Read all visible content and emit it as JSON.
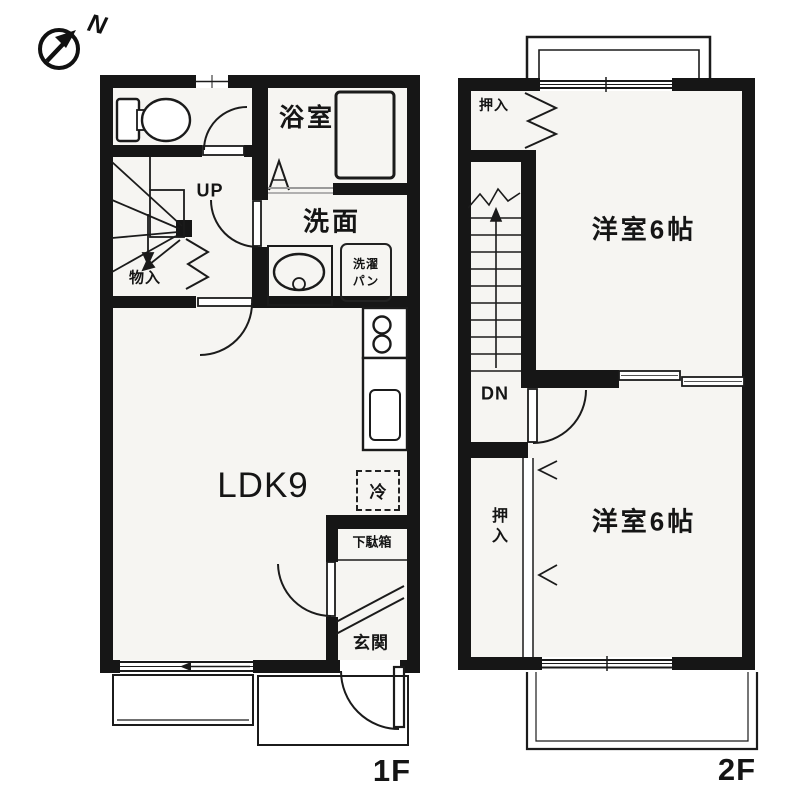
{
  "compass": {
    "north_label": "N"
  },
  "floor1": {
    "floor_label": "1F",
    "bath_label": "浴室",
    "washroom_label": "洗面",
    "laundry_pan_label_line1": "洗濯",
    "laundry_pan_label_line2": "パン",
    "stairs_up_label": "UP",
    "storage_label": "物入",
    "ldk_label": "LDK9",
    "fridge_label": "冷",
    "shoe_cabinet_label": "下駄箱",
    "entrance_label": "玄関"
  },
  "floor2": {
    "floor_label": "2F",
    "closet_upper_label": "押入",
    "bedroom_upper_label": "洋室6帖",
    "stairs_down_label": "DN",
    "closet_lower_label": "押入",
    "bedroom_lower_label": "洋室6帖"
  },
  "colors": {
    "wall": "#161616",
    "line": "#1b1b1b",
    "room_fill": "#f6f5f2"
  }
}
